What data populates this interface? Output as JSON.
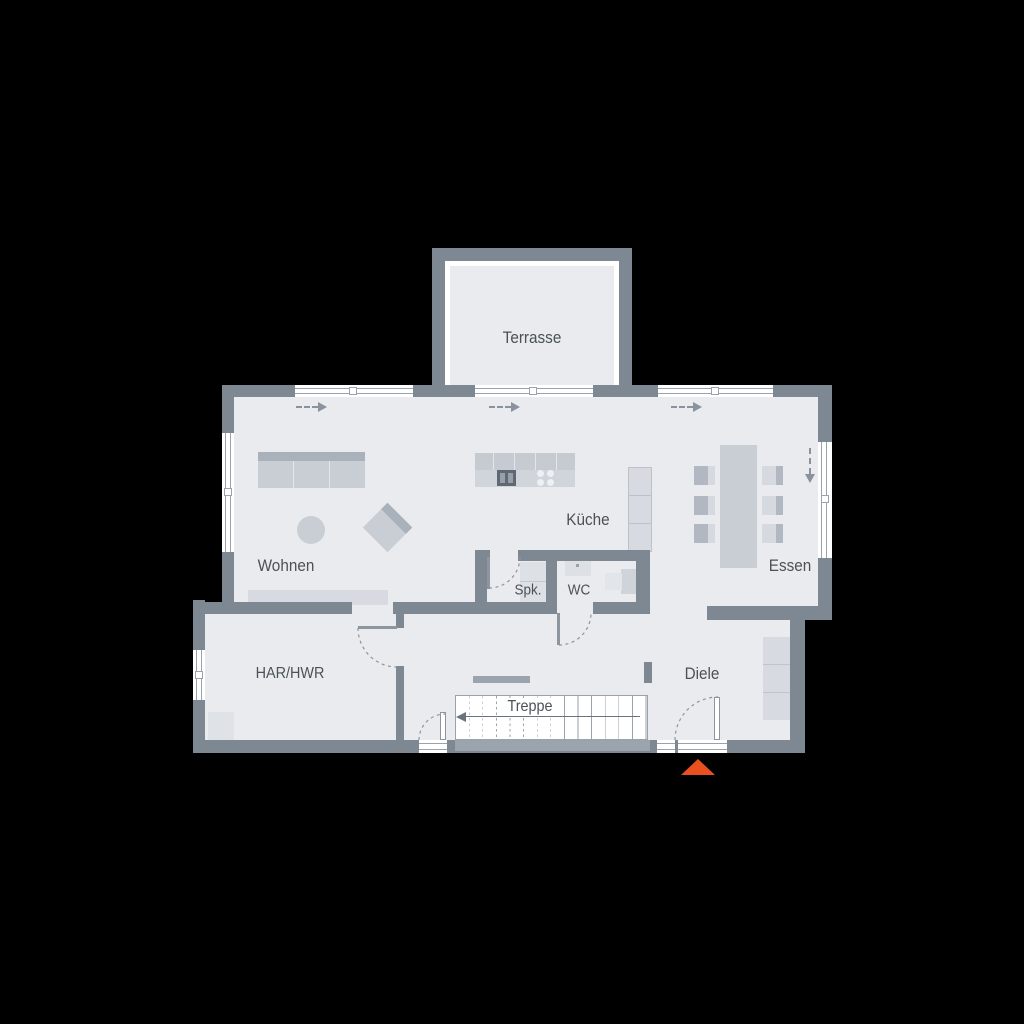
{
  "colors": {
    "background": "#000000",
    "wall": "#7e8893",
    "wall_light": "#9ba3ad",
    "floor": "#e9ebee",
    "furn_light": "#d7dbe1",
    "furn_mid": "#c9ced5",
    "furn_dark": "#a9b1bb",
    "outline": "#9aa2ac",
    "text": "#4b5158",
    "accent": "#e8501f"
  },
  "rooms": {
    "terrasse": {
      "label": "Terrasse"
    },
    "wohnen": {
      "label": "Wohnen"
    },
    "kueche": {
      "label": "Küche"
    },
    "essen": {
      "label": "Essen"
    },
    "spk": {
      "label": "Spk."
    },
    "wc": {
      "label": "WC"
    },
    "har_hwr": {
      "label": "HAR/HWR"
    },
    "diele": {
      "label": "Diele"
    },
    "treppe": {
      "label": "Treppe"
    }
  }
}
